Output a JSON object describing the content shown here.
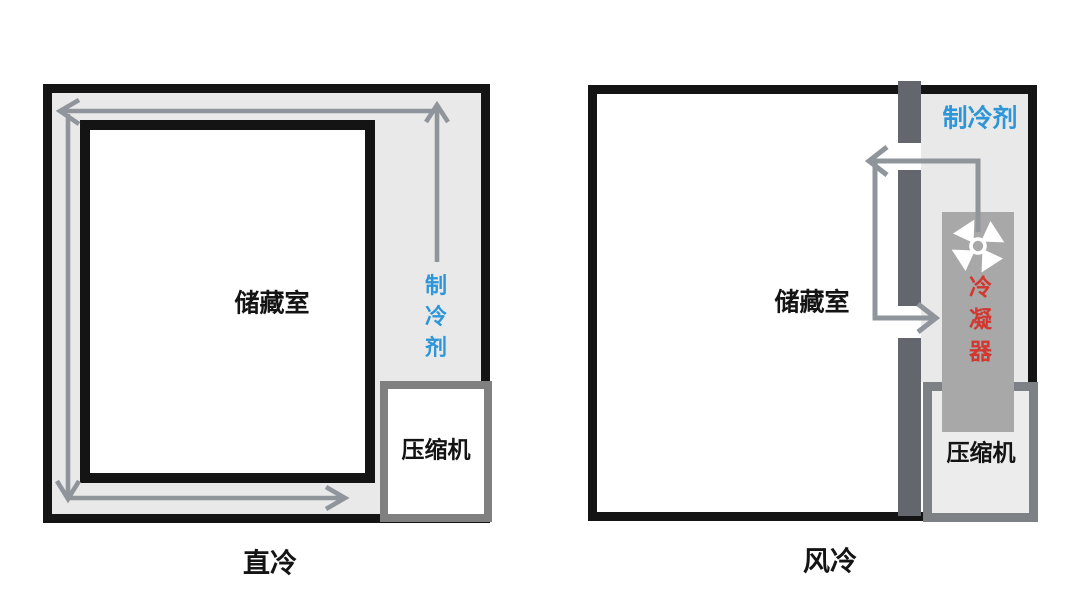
{
  "left_diagram": {
    "caption": "直冷",
    "storage_room_label": "储藏室",
    "refrigerant_label": "制冷剂",
    "compressor_label": "压缩机"
  },
  "right_diagram": {
    "caption": "风冷",
    "storage_room_label": "储藏室",
    "refrigerant_label": "制冷剂",
    "condenser_label": "冷凝器",
    "compressor_label": "压缩机",
    "fan_icon": "pinwheel-fan-icon"
  },
  "colors": {
    "ink_black": "#141414",
    "channel_gray": "#e9e9e9",
    "partition_gray": "#63676d",
    "condenser_gray": "#a8a8a8",
    "arrow_gray": "#90959b",
    "compressor_border_gray": "#7d8186",
    "compressor_fill_right": "#ececec",
    "refrigerant_blue": "#2e96d8",
    "condenser_red": "#d23730"
  }
}
